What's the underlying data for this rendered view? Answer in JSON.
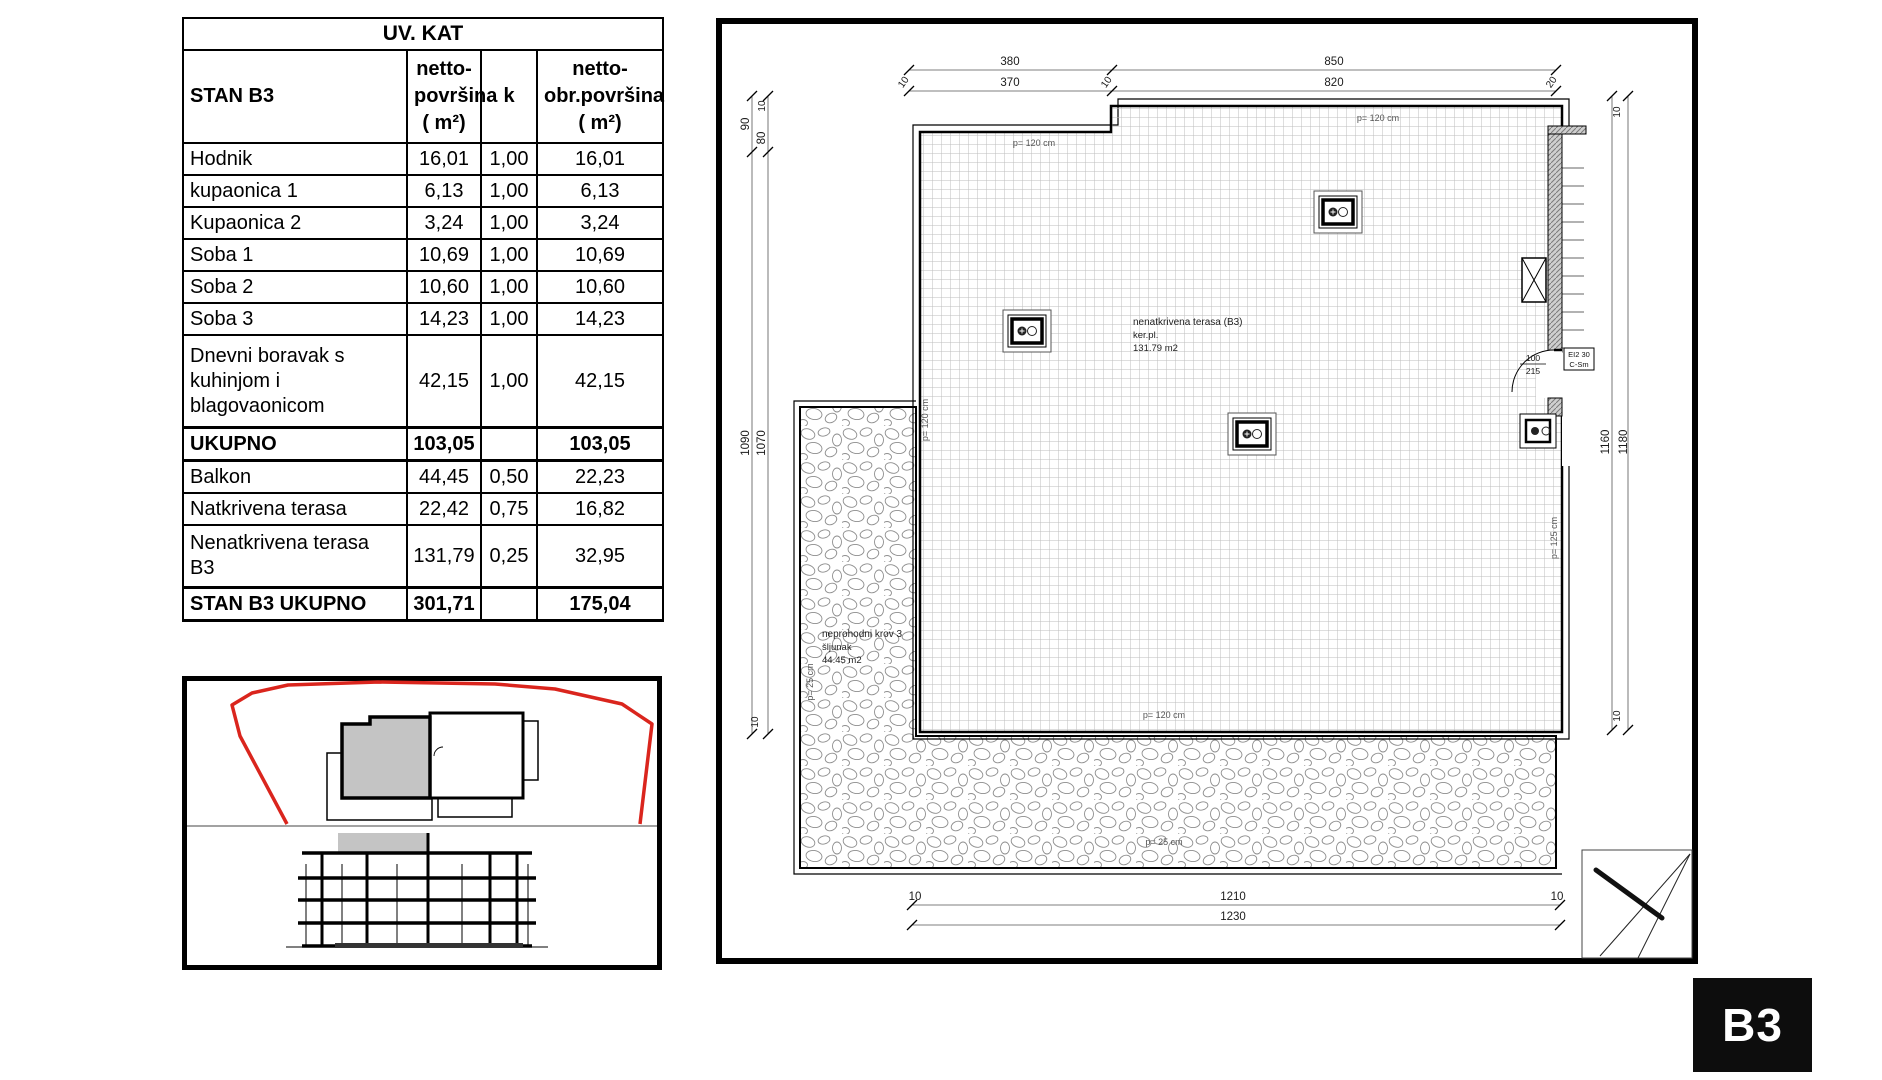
{
  "table": {
    "title": "UV. KAT",
    "headers": {
      "name": "STAN B3",
      "netto": "netto-\npovršina\n( m²)",
      "k": "k",
      "obr": "netto-\nobr.površina\n( m²)"
    },
    "rows": [
      {
        "name": "Hodnik",
        "netto": "16,01",
        "k": "1,00",
        "obr": "16,01"
      },
      {
        "name": "kupaonica 1",
        "netto": "6,13",
        "k": "1,00",
        "obr": "6,13"
      },
      {
        "name": "Kupaonica 2",
        "netto": "3,24",
        "k": "1,00",
        "obr": "3,24"
      },
      {
        "name": "Soba 1",
        "netto": "10,69",
        "k": "1,00",
        "obr": "10,69"
      },
      {
        "name": "Soba 2",
        "netto": "10,60",
        "k": "1,00",
        "obr": "10,60"
      },
      {
        "name": "Soba 3",
        "netto": "14,23",
        "k": "1,00",
        "obr": "14,23"
      },
      {
        "name": "Dnevni boravak s\nkuhinjom i\nblagovaonicom",
        "netto": "42,15",
        "k": "1,00",
        "obr": "42,15"
      },
      {
        "name": "UKUPNO",
        "netto": "103,05",
        "k": "",
        "obr": "103,05"
      },
      {
        "name": "Balkon",
        "netto": "44,45",
        "k": "0,50",
        "obr": "22,23"
      },
      {
        "name": "Natkrivena terasa",
        "netto": "22,42",
        "k": "0,75",
        "obr": "16,82"
      },
      {
        "name": "Nenatkrivena  terasa\nB3",
        "netto": "131,79",
        "k": "0,25",
        "obr": "32,95"
      },
      {
        "name": "STAN B3 UKUPNO",
        "netto": "301,71",
        "k": "",
        "obr": "175,04"
      }
    ]
  },
  "plan": {
    "dims": {
      "top": {
        "a": "380",
        "b": "370",
        "c": "850",
        "d": "820",
        "t1": "10",
        "t2": "10",
        "t3": "20"
      },
      "left": {
        "t1": "10",
        "a": "90",
        "b": "80",
        "c": "1090",
        "d": "1070",
        "t2": "10"
      },
      "right": {
        "t1": "10",
        "a": "1160",
        "b": "1180",
        "t2": "10"
      },
      "bottom": {
        "t1": "10",
        "a": "1210",
        "b": "1230",
        "t2": "10"
      }
    },
    "terrace_label": {
      "l1": "nenatkrivena terasa (B3)",
      "l2": "ker.pl.",
      "l3": "131.79   m2"
    },
    "roof_label": {
      "l1": "neprohodni krov 3",
      "l2": "šljunak",
      "l3": "44.45    m2"
    },
    "surface": {
      "p120": "p= 120 cm",
      "p125": "p= 125 cm",
      "p25": "p= 25 cm"
    },
    "door": {
      "w": "100",
      "h": "215",
      "fire1": "EI2 30",
      "fire2": "C-Sm"
    },
    "badge": "B3"
  }
}
